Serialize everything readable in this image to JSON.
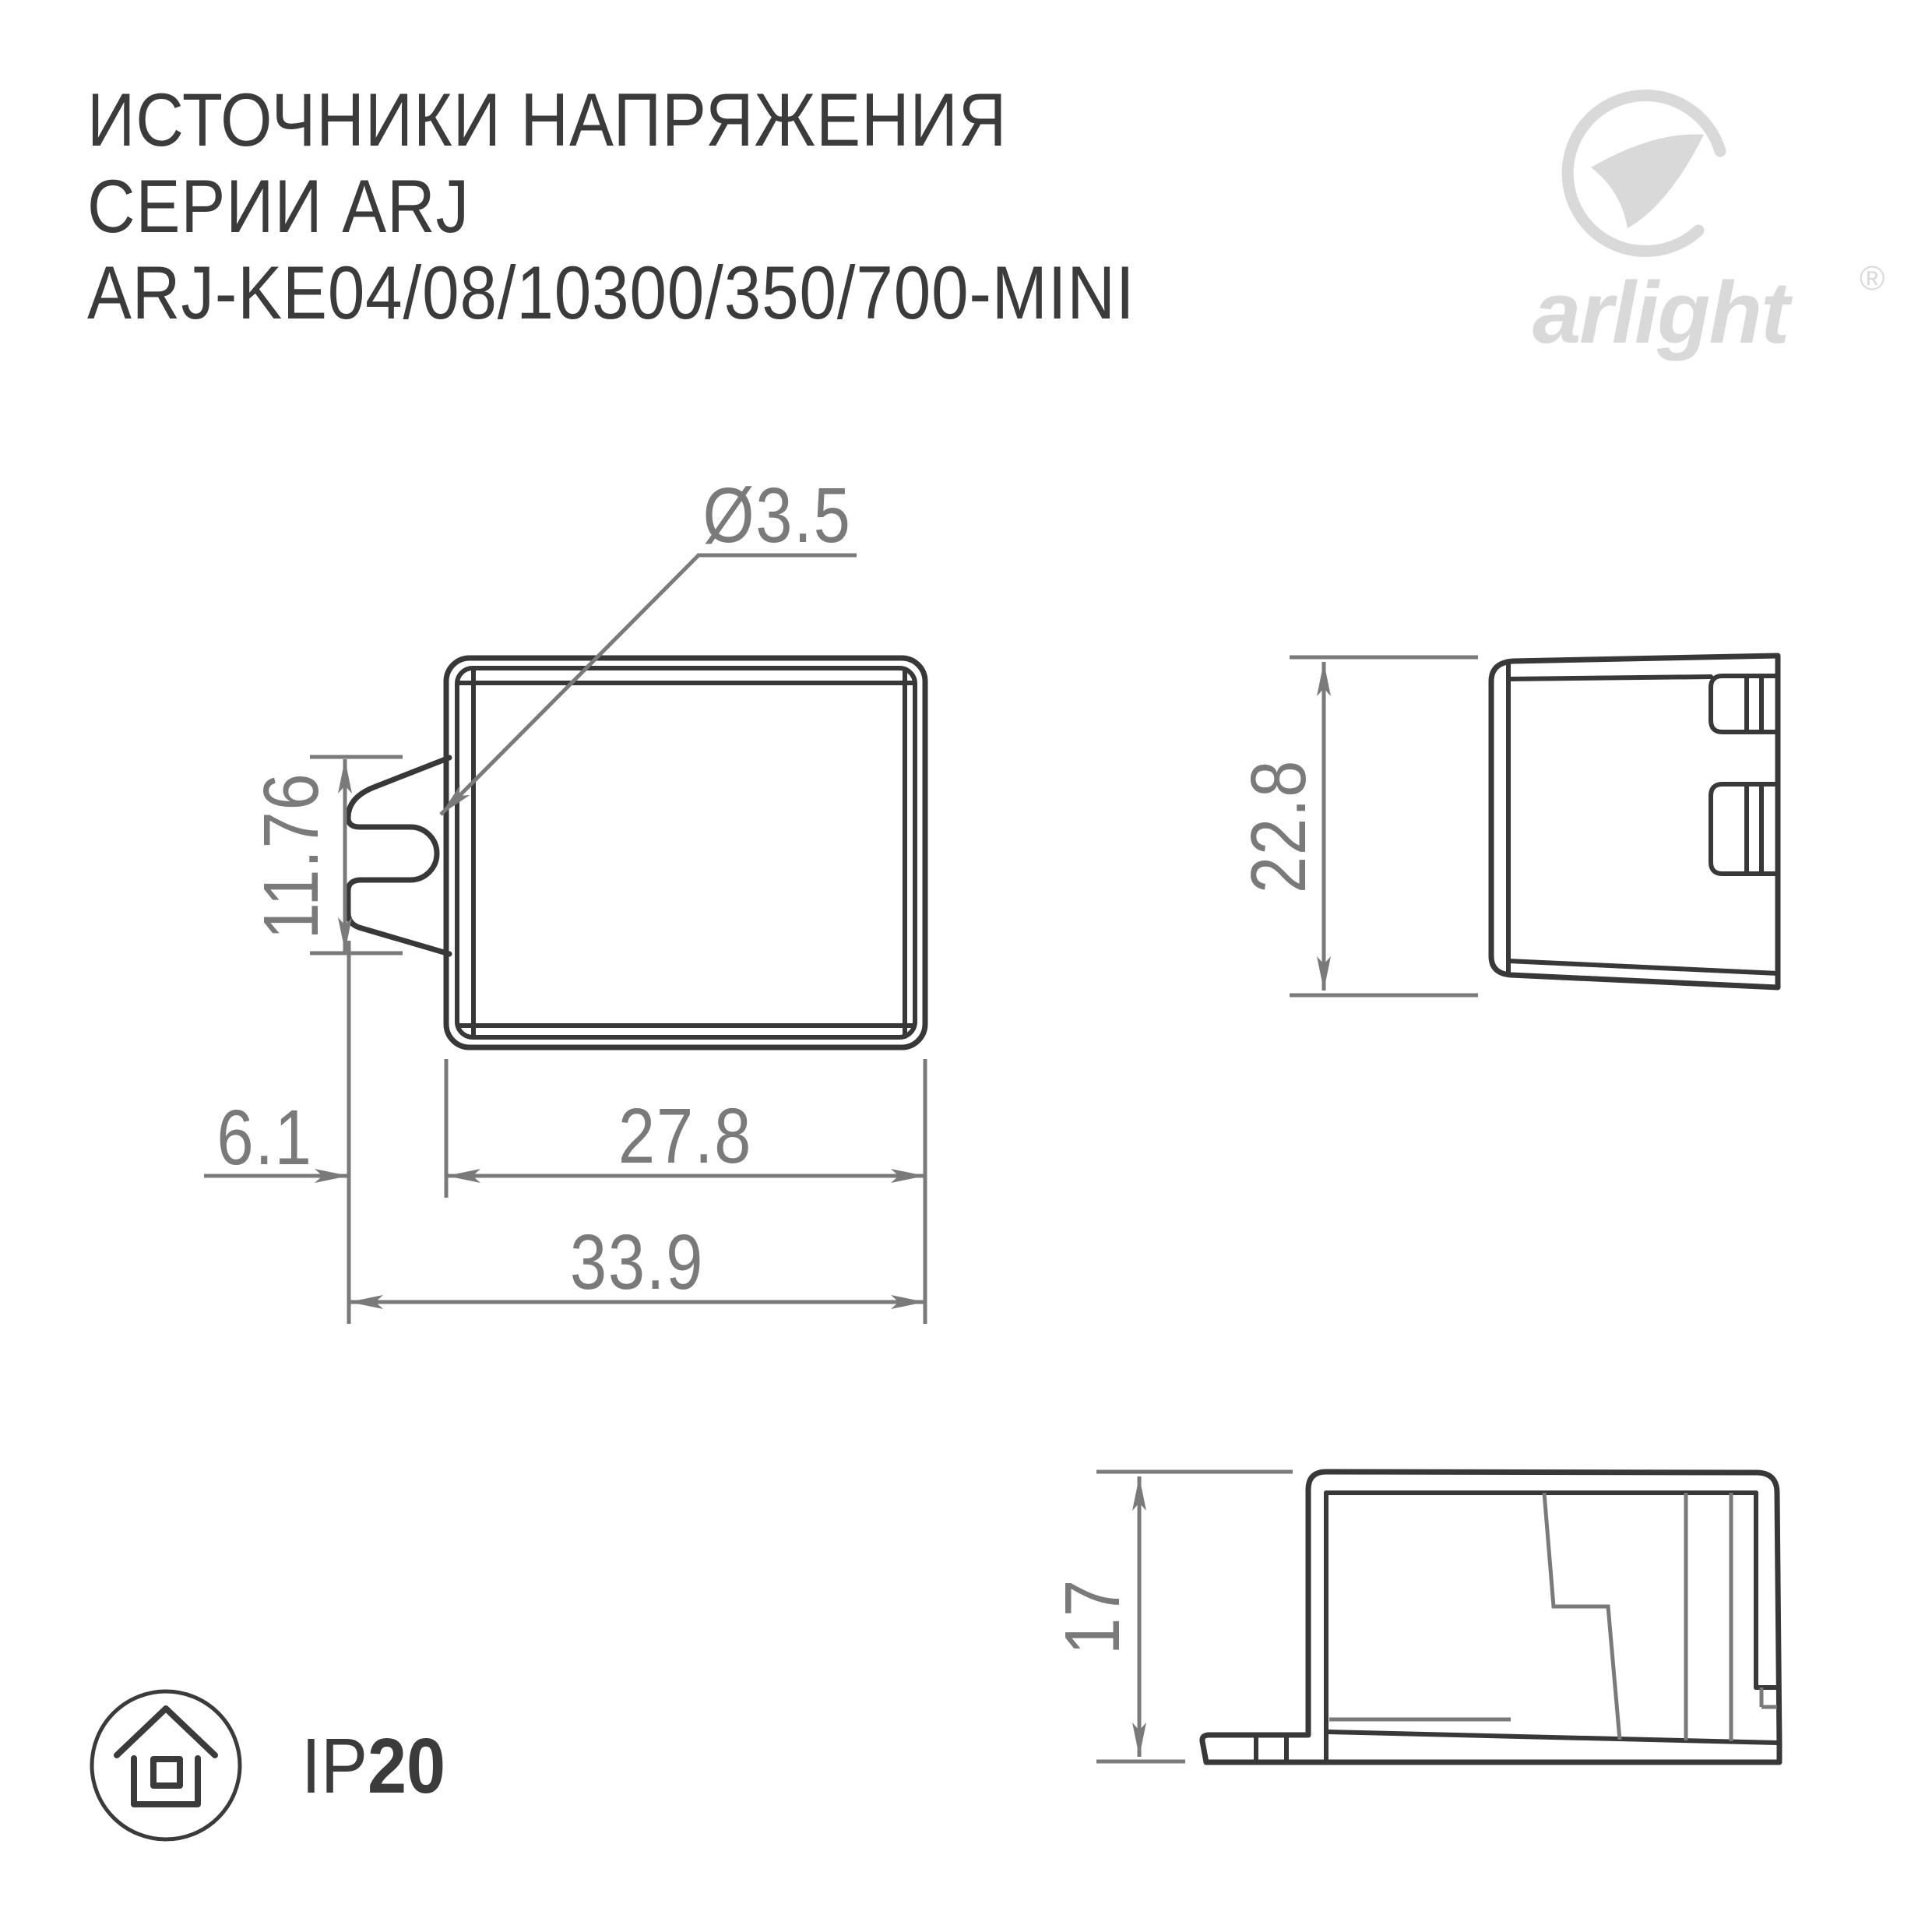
{
  "title": {
    "line1": "ИСТОЧНИКИ НАПРЯЖЕНИЯ",
    "line2": "СЕРИИ ARJ",
    "line3": "ARJ-KE04/08/10300/350/700-MINI"
  },
  "logo": {
    "brand": "arlight",
    "registered": "®"
  },
  "views": {
    "front": {
      "dimensions": {
        "hole_diameter": "Ø3.5",
        "clip_height": "11.76",
        "clip_offset": "6.1",
        "body_width": "27.8",
        "total_width": "33.9"
      }
    },
    "side": {
      "dimensions": {
        "height": "22.8"
      }
    },
    "profile": {
      "dimensions": {
        "height": "17"
      }
    }
  },
  "footer": {
    "ip_prefix": "IP",
    "ip_value": "20"
  },
  "colors": {
    "line_dark": "#383838",
    "dimension_gray": "#7a7a7a",
    "logo_gray": "#d9d9d9",
    "background": "#ffffff"
  }
}
